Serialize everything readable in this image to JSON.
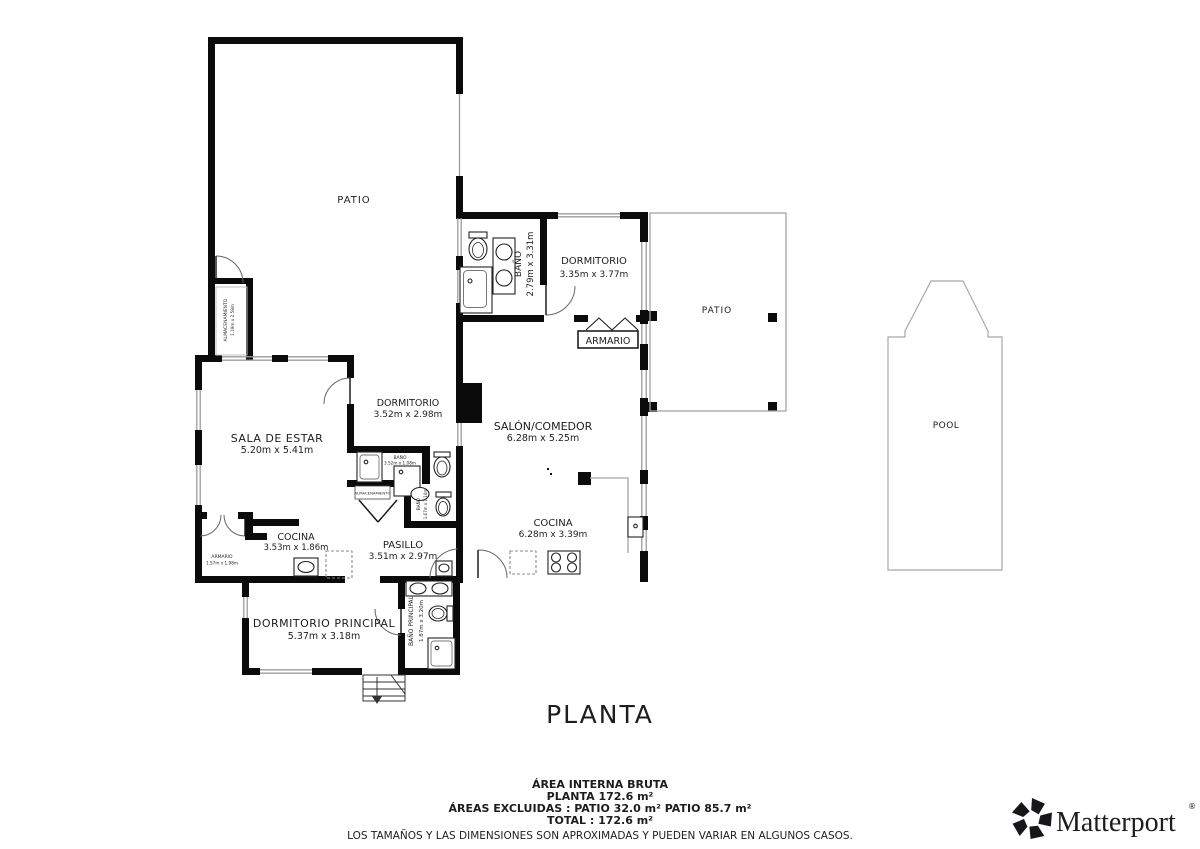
{
  "title": "PLANTA",
  "rooms": {
    "patio_main": {
      "name": "PATIO"
    },
    "patio_right": {
      "name": "PATIO"
    },
    "pool": {
      "name": "POOL"
    },
    "bano_top": {
      "name": "BAÑO",
      "dims": "2.79m x 3.31m"
    },
    "dormitorio_top": {
      "name": "DORMITORIO",
      "dims": "3.35m x 3.77m"
    },
    "armario_top": {
      "name": "ARMARIO"
    },
    "sala_de_estar": {
      "name": "SALA DE ESTAR",
      "dims": "5.20m x 5.41m"
    },
    "dormitorio_mid": {
      "name": "DORMITORIO",
      "dims": "3.52m x 2.98m"
    },
    "salon_comedor": {
      "name": "SALÓN/COMEDOR",
      "dims": "6.28m x 5.25m"
    },
    "bano_small": {
      "name": "BAÑO",
      "dims": "3.52m x 1.08m"
    },
    "bano_hall": {
      "name": "BAÑO",
      "dims": "1.67m x 1.10m"
    },
    "almacenamiento_box": {
      "name": "ALMACENAMIENTO"
    },
    "almacenamiento_left": {
      "name": "ALMACENAMIENTO",
      "dims": "1.19m x 2.58m"
    },
    "cocina_left": {
      "name": "COCINA",
      "dims": "3.53m x 1.86m"
    },
    "pasillo": {
      "name": "PASILLO",
      "dims": "3.51m x 2.97m"
    },
    "cocina_right": {
      "name": "COCINA",
      "dims": "6.28m x 3.39m"
    },
    "armario_bottom": {
      "name": "ARMARIO",
      "dims": "1.57m x 1.98m"
    },
    "dormitorio_principal": {
      "name": "DORMITORIO PRINCIPAL",
      "dims": "5.37m x 3.18m"
    },
    "bano_principal": {
      "name": "BAÑO PRINCIPAL",
      "dims": "1.87m x 3.20m"
    }
  },
  "summary": {
    "heading": "ÁREA INTERNA BRUTA",
    "planta_line": "PLANTA 172.6 m²",
    "excluded_line": "ÁREAS EXCLUIDAS :  PATIO 32.0 m²   PATIO 85.7 m²",
    "total_line": "TOTAL :  172.6 m²",
    "disclaimer": "LOS TAMAÑOS Y LAS DIMENSIONES SON APROXIMADAS Y PUEDEN VARIAR EN ALGUNOS CASOS."
  },
  "brand": {
    "name": "Matterport",
    "mark": "®"
  },
  "colors": {
    "wall": "#0b0b0b",
    "window": "#9b9b9b",
    "label": "#1d1d1d",
    "muted": "#8f8f8f"
  }
}
